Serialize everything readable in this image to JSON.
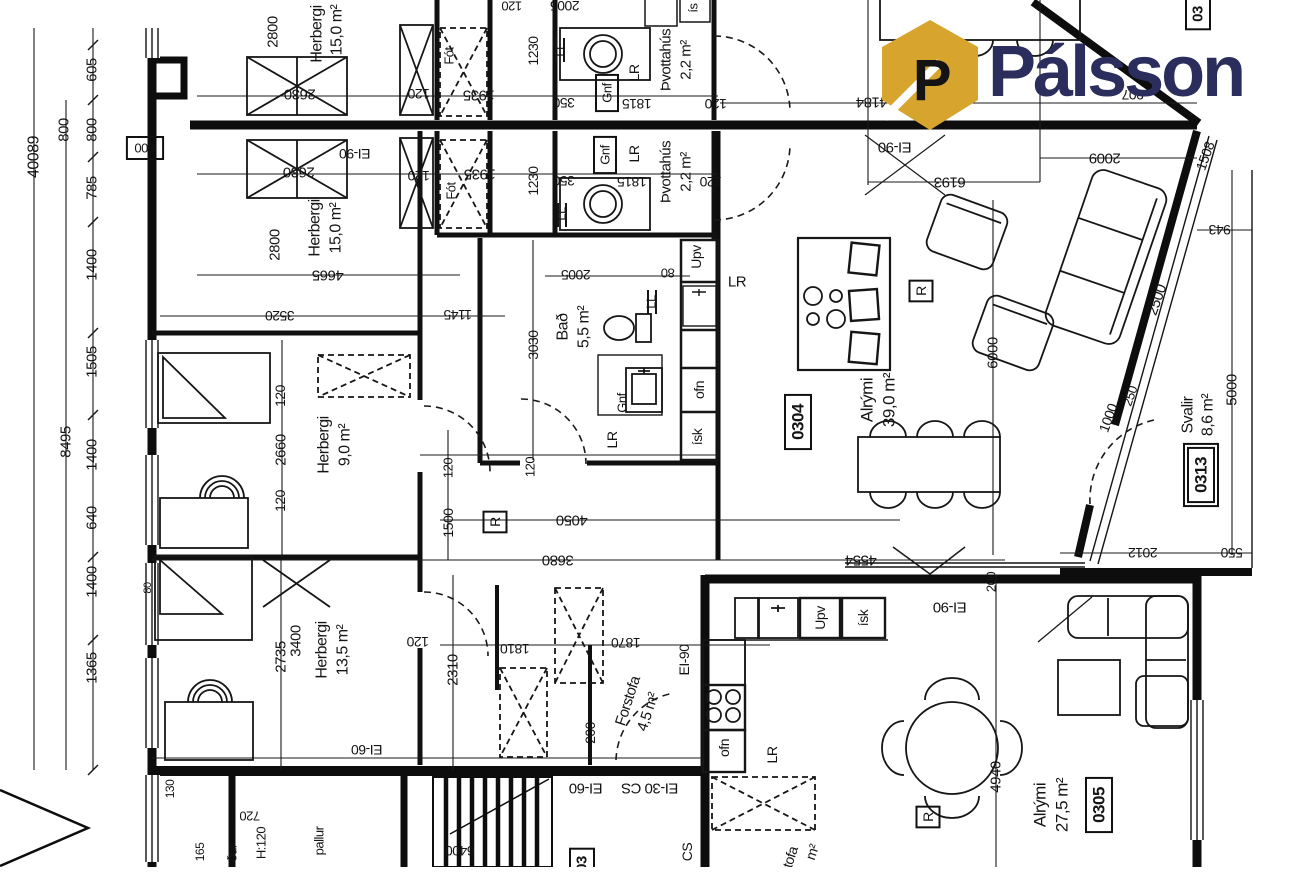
{
  "logo": {
    "text": "Pálsson",
    "icon": "house-p-icon",
    "brand_color": "#2b2d5c",
    "icon_color": "#d7a52e"
  },
  "plan": {
    "rooms": [
      {
        "number": "0304",
        "name": "Alrými",
        "area": "39,0 m²"
      },
      {
        "number": "0305",
        "name": "Alrými",
        "area": "27,5 m²"
      },
      {
        "number": "0313",
        "name": "Svalir",
        "area": "8,6 m²"
      },
      {
        "name": "Herbergi",
        "area": "15,0 m²"
      },
      {
        "name": "Herbergi",
        "area": "15,0 m²"
      },
      {
        "name": "Herbergi",
        "area": "9,0 m²"
      },
      {
        "name": "Herbergi",
        "area": "13,5 m²"
      },
      {
        "name": "Bað",
        "area": "5,5 m²"
      },
      {
        "name": "Þvottahús",
        "area": "2,2 m²"
      },
      {
        "name": "Þvottahús",
        "area": "2,2 m²"
      },
      {
        "name": "Forstofa",
        "area": "4,5 m²"
      }
    ],
    "fire_ratings": [
      "EI-90",
      "EI-60",
      "EI-30 CS",
      "CS"
    ],
    "labels": [
      {
        "t": "40089",
        "x": 34,
        "y": 157,
        "r": -90,
        "s": 16,
        "k": "dim"
      },
      {
        "t": "800",
        "x": 64,
        "y": 130,
        "r": -90,
        "s": 15,
        "k": "dim"
      },
      {
        "t": "605",
        "x": 92,
        "y": 70,
        "r": -90,
        "s": 15,
        "k": "dim"
      },
      {
        "t": "800",
        "x": 92,
        "y": 130,
        "r": -90,
        "s": 15,
        "k": "dim"
      },
      {
        "t": "785",
        "x": 92,
        "y": 188,
        "r": -90,
        "s": 15,
        "k": "dim"
      },
      {
        "t": "1400",
        "x": 92,
        "y": 265,
        "r": -90,
        "s": 15,
        "k": "dim"
      },
      {
        "t": "1505",
        "x": 92,
        "y": 362,
        "r": -90,
        "s": 15,
        "k": "dim"
      },
      {
        "t": "8495",
        "x": 66,
        "y": 442,
        "r": -90,
        "s": 15,
        "k": "dim"
      },
      {
        "t": "1400",
        "x": 92,
        "y": 455,
        "r": -90,
        "s": 15,
        "k": "dim"
      },
      {
        "t": "640",
        "x": 92,
        "y": 518,
        "r": -90,
        "s": 15,
        "k": "dim"
      },
      {
        "t": "1400",
        "x": 92,
        "y": 582,
        "r": -90,
        "s": 15,
        "k": "dim"
      },
      {
        "t": "1365",
        "x": 92,
        "y": 668,
        "r": -90,
        "s": 15,
        "k": "dim"
      },
      {
        "t": "600",
        "x": 145,
        "y": 148,
        "r": 180,
        "s": 13,
        "k": "dim",
        "b": 1
      },
      {
        "t": "80",
        "x": 148,
        "y": 588,
        "r": -90,
        "s": 11,
        "k": "dim"
      },
      {
        "t": "130",
        "x": 170,
        "y": 789,
        "r": -90,
        "s": 12,
        "k": "dim"
      },
      {
        "t": "165",
        "x": 200,
        "y": 852,
        "r": -90,
        "s": 12,
        "k": "dim"
      },
      {
        "t": "720",
        "x": 250,
        "y": 816,
        "r": 180,
        "s": 13,
        "k": "dim"
      },
      {
        "t": "H:120",
        "x": 261,
        "y": 843,
        "r": -90,
        "s": 13,
        "k": "note"
      },
      {
        "t": "ður",
        "x": 232,
        "y": 853,
        "r": -90,
        "s": 13,
        "k": "note"
      },
      {
        "t": "pallur",
        "x": 319,
        "y": 841,
        "r": -90,
        "s": 13,
        "k": "note"
      },
      {
        "t": "6400",
        "x": 460,
        "y": 851,
        "r": 180,
        "s": 14,
        "k": "dim"
      },
      {
        "t": "2800",
        "x": 273,
        "y": 32,
        "r": -90,
        "s": 15,
        "k": "dim"
      },
      {
        "t": "Herbergi",
        "x": 317,
        "y": 34,
        "r": -90,
        "s": 16,
        "k": "room"
      },
      {
        "t": "15,0 m²",
        "x": 337,
        "y": 30,
        "r": -90,
        "s": 16,
        "k": "room"
      },
      {
        "t": "2630",
        "x": 300,
        "y": 94,
        "r": 180,
        "s": 15,
        "k": "dim"
      },
      {
        "t": "120",
        "x": 419,
        "y": 94,
        "r": 180,
        "s": 14,
        "k": "dim"
      },
      {
        "t": "Fót",
        "x": 449,
        "y": 56,
        "r": -90,
        "s": 13,
        "k": "app"
      },
      {
        "t": "1935",
        "x": 479,
        "y": 95,
        "r": 180,
        "s": 15,
        "k": "dim"
      },
      {
        "t": "1230",
        "x": 533,
        "y": 51,
        "r": -90,
        "s": 14,
        "k": "dim"
      },
      {
        "t": "LL",
        "x": 560,
        "y": 50,
        "r": -90,
        "s": 13,
        "k": "app"
      },
      {
        "t": "350",
        "x": 564,
        "y": 103,
        "r": 180,
        "s": 14,
        "k": "dim"
      },
      {
        "t": "Gnf",
        "x": 607,
        "y": 93,
        "r": -90,
        "s": 13,
        "k": "app",
        "b": 1
      },
      {
        "t": "LR",
        "x": 634,
        "y": 73,
        "r": -90,
        "s": 14,
        "k": "app"
      },
      {
        "t": "Þvottahús",
        "x": 666,
        "y": 60,
        "r": -90,
        "s": 15,
        "k": "room"
      },
      {
        "t": "2,2 m²",
        "x": 686,
        "y": 60,
        "r": -90,
        "s": 15,
        "k": "room"
      },
      {
        "t": "1815",
        "x": 637,
        "y": 104,
        "r": 180,
        "s": 14,
        "k": "dim"
      },
      {
        "t": "120",
        "x": 716,
        "y": 104,
        "r": 180,
        "s": 14,
        "k": "dim"
      },
      {
        "t": "2005",
        "x": 565,
        "y": 6,
        "r": 180,
        "s": 14,
        "k": "dim"
      },
      {
        "t": "ís",
        "x": 693,
        "y": 8,
        "r": -90,
        "s": 13,
        "k": "app"
      },
      {
        "t": "120",
        "x": 512,
        "y": 6,
        "r": 180,
        "s": 13,
        "k": "dim"
      },
      {
        "t": "4184",
        "x": 872,
        "y": 102,
        "r": 180,
        "s": 15,
        "k": "dim"
      },
      {
        "t": "907",
        "x": 1133,
        "y": 95,
        "r": 180,
        "s": 14,
        "k": "dim"
      },
      {
        "t": "03",
        "x": 1198,
        "y": 14,
        "r": -90,
        "s": 15,
        "k": "num",
        "b": 1
      },
      {
        "t": "EI-90",
        "x": 895,
        "y": 147,
        "r": 180,
        "s": 15,
        "k": "fire"
      },
      {
        "t": "2630",
        "x": 299,
        "y": 172,
        "r": 180,
        "s": 15,
        "k": "dim"
      },
      {
        "t": "EI-90",
        "x": 355,
        "y": 154,
        "r": 180,
        "s": 14,
        "k": "fire"
      },
      {
        "t": "120",
        "x": 419,
        "y": 176,
        "r": 180,
        "s": 14,
        "k": "dim"
      },
      {
        "t": "1935",
        "x": 480,
        "y": 174,
        "r": 180,
        "s": 15,
        "k": "dim"
      },
      {
        "t": "Fót",
        "x": 451,
        "y": 191,
        "r": -90,
        "s": 13,
        "k": "app"
      },
      {
        "t": "1230",
        "x": 533,
        "y": 181,
        "r": -90,
        "s": 14,
        "k": "dim"
      },
      {
        "t": "350",
        "x": 564,
        "y": 181,
        "r": 180,
        "s": 14,
        "k": "dim"
      },
      {
        "t": "LL",
        "x": 561,
        "y": 214,
        "r": -90,
        "s": 13,
        "k": "app"
      },
      {
        "t": "Gnf",
        "x": 605,
        "y": 155,
        "r": -90,
        "s": 13,
        "k": "app",
        "b": 1
      },
      {
        "t": "LR",
        "x": 634,
        "y": 154,
        "r": -90,
        "s": 14,
        "k": "app"
      },
      {
        "t": "Þvottahús",
        "x": 666,
        "y": 172,
        "r": -90,
        "s": 15,
        "k": "room"
      },
      {
        "t": "2,2 m²",
        "x": 686,
        "y": 172,
        "r": -90,
        "s": 15,
        "k": "room"
      },
      {
        "t": "1815",
        "x": 632,
        "y": 182,
        "r": 180,
        "s": 14,
        "k": "dim"
      },
      {
        "t": "120",
        "x": 711,
        "y": 182,
        "r": 180,
        "s": 14,
        "k": "dim"
      },
      {
        "t": "2800",
        "x": 275,
        "y": 245,
        "r": -90,
        "s": 15,
        "k": "dim"
      },
      {
        "t": "Herbergi",
        "x": 315,
        "y": 228,
        "r": -90,
        "s": 16,
        "k": "room"
      },
      {
        "t": "15,0 m²",
        "x": 336,
        "y": 228,
        "r": -90,
        "s": 16,
        "k": "room"
      },
      {
        "t": "4665",
        "x": 328,
        "y": 275,
        "r": 180,
        "s": 15,
        "k": "dim"
      },
      {
        "t": "1145",
        "x": 458,
        "y": 315,
        "r": 180,
        "s": 14,
        "k": "dim"
      },
      {
        "t": "3520",
        "x": 280,
        "y": 316,
        "r": 180,
        "s": 14,
        "k": "dim"
      },
      {
        "t": "120",
        "x": 280,
        "y": 396,
        "r": -90,
        "s": 14,
        "k": "dim"
      },
      {
        "t": "2660",
        "x": 281,
        "y": 450,
        "r": -90,
        "s": 15,
        "k": "dim"
      },
      {
        "t": "120",
        "x": 280,
        "y": 501,
        "r": -90,
        "s": 14,
        "k": "dim"
      },
      {
        "t": "Herbergi",
        "x": 324,
        "y": 445,
        "r": -90,
        "s": 16,
        "k": "room"
      },
      {
        "t": "9,0 m²",
        "x": 345,
        "y": 445,
        "r": -90,
        "s": 16,
        "k": "room"
      },
      {
        "t": "1500",
        "x": 448,
        "y": 523,
        "r": -90,
        "s": 14,
        "k": "dim"
      },
      {
        "t": "120",
        "x": 448,
        "y": 468,
        "r": -90,
        "s": 13,
        "k": "dim"
      },
      {
        "t": "120",
        "x": 530,
        "y": 467,
        "r": -90,
        "s": 13,
        "k": "dim"
      },
      {
        "t": "R",
        "x": 495,
        "y": 522,
        "r": -90,
        "s": 14,
        "k": "app",
        "b": 1
      },
      {
        "t": "4050",
        "x": 572,
        "y": 520,
        "r": 180,
        "s": 15,
        "k": "dim"
      },
      {
        "t": "3680",
        "x": 558,
        "y": 560,
        "r": 180,
        "s": 15,
        "k": "dim"
      },
      {
        "t": "3030",
        "x": 533,
        "y": 345,
        "r": -90,
        "s": 14,
        "k": "dim"
      },
      {
        "t": "Bað",
        "x": 563,
        "y": 327,
        "r": -90,
        "s": 16,
        "k": "room"
      },
      {
        "t": "5,5 m²",
        "x": 584,
        "y": 327,
        "r": -90,
        "s": 16,
        "k": "room"
      },
      {
        "t": "2005",
        "x": 576,
        "y": 275,
        "r": 180,
        "s": 14,
        "k": "dim"
      },
      {
        "t": "80",
        "x": 668,
        "y": 273,
        "r": 180,
        "s": 13,
        "k": "dim"
      },
      {
        "t": "LL",
        "x": 651,
        "y": 302,
        "r": -90,
        "s": 13,
        "k": "app"
      },
      {
        "t": "Gnf",
        "x": 622,
        "y": 403,
        "r": -90,
        "s": 13,
        "k": "app"
      },
      {
        "t": "LR",
        "x": 612,
        "y": 440,
        "r": -90,
        "s": 14,
        "k": "app"
      },
      {
        "t": "Upv",
        "x": 696,
        "y": 257,
        "r": -90,
        "s": 14,
        "k": "app"
      },
      {
        "t": "ofn",
        "x": 699,
        "y": 390,
        "r": -90,
        "s": 14,
        "k": "app"
      },
      {
        "t": "ísk",
        "x": 697,
        "y": 437,
        "r": -90,
        "s": 14,
        "k": "app"
      },
      {
        "t": "LR",
        "x": 737,
        "y": 282,
        "r": 0,
        "s": 15,
        "k": "app"
      },
      {
        "t": "R",
        "x": 921,
        "y": 291,
        "r": -90,
        "s": 14,
        "k": "app",
        "b": 1
      },
      {
        "t": "6193",
        "x": 950,
        "y": 182,
        "r": 180,
        "s": 15,
        "k": "dim"
      },
      {
        "t": "6000",
        "x": 993,
        "y": 353,
        "r": -90,
        "s": 15,
        "k": "dim"
      },
      {
        "t": "0304",
        "x": 798,
        "y": 422,
        "r": -90,
        "s": 17,
        "k": "num",
        "b": 1
      },
      {
        "t": "Alrými",
        "x": 867,
        "y": 400,
        "r": -90,
        "s": 17,
        "k": "room"
      },
      {
        "t": "39,0 m²",
        "x": 889,
        "y": 400,
        "r": -90,
        "s": 17,
        "k": "room"
      },
      {
        "t": "2009",
        "x": 1105,
        "y": 158,
        "r": 180,
        "s": 15,
        "k": "dim"
      },
      {
        "t": "1508",
        "x": 1205,
        "y": 156,
        "r": -70,
        "s": 14,
        "k": "dim"
      },
      {
        "t": "2500",
        "x": 1157,
        "y": 300,
        "r": -70,
        "s": 15,
        "k": "dim"
      },
      {
        "t": "250",
        "x": 1130,
        "y": 396,
        "r": -70,
        "s": 13,
        "k": "dim"
      },
      {
        "t": "1000",
        "x": 1108,
        "y": 418,
        "r": -70,
        "s": 14,
        "k": "dim"
      },
      {
        "t": "Svalir",
        "x": 1188,
        "y": 415,
        "r": -90,
        "s": 16,
        "k": "room"
      },
      {
        "t": "8,6 m²",
        "x": 1208,
        "y": 415,
        "r": -90,
        "s": 16,
        "k": "room"
      },
      {
        "t": "5000",
        "x": 1232,
        "y": 390,
        "r": -90,
        "s": 15,
        "k": "dim"
      },
      {
        "t": "0313",
        "x": 1201,
        "y": 475,
        "r": -90,
        "s": 17,
        "k": "num",
        "b": 2
      },
      {
        "t": "943",
        "x": 1220,
        "y": 230,
        "r": 180,
        "s": 14,
        "k": "dim"
      },
      {
        "t": "2012",
        "x": 1143,
        "y": 553,
        "r": 180,
        "s": 14,
        "k": "dim"
      },
      {
        "t": "550",
        "x": 1232,
        "y": 553,
        "r": 180,
        "s": 14,
        "k": "dim"
      },
      {
        "t": "4554",
        "x": 861,
        "y": 560,
        "r": 180,
        "s": 15,
        "k": "dim"
      },
      {
        "t": "Herbergi",
        "x": 322,
        "y": 650,
        "r": -90,
        "s": 16,
        "k": "room"
      },
      {
        "t": "13,5 m²",
        "x": 343,
        "y": 650,
        "r": -90,
        "s": 16,
        "k": "room"
      },
      {
        "t": "2735",
        "x": 281,
        "y": 657,
        "r": -90,
        "s": 15,
        "k": "dim"
      },
      {
        "t": "3400",
        "x": 296,
        "y": 641,
        "r": -90,
        "s": 15,
        "k": "dim"
      },
      {
        "t": "120",
        "x": 418,
        "y": 642,
        "r": 180,
        "s": 14,
        "k": "dim"
      },
      {
        "t": "2310",
        "x": 453,
        "y": 670,
        "r": -90,
        "s": 15,
        "k": "dim"
      },
      {
        "t": "1810",
        "x": 515,
        "y": 649,
        "r": 180,
        "s": 14,
        "k": "dim"
      },
      {
        "t": "1870",
        "x": 626,
        "y": 643,
        "r": 180,
        "s": 14,
        "k": "dim"
      },
      {
        "t": "EI-90",
        "x": 684,
        "y": 660,
        "r": -90,
        "s": 14,
        "k": "fire"
      },
      {
        "t": "Forstofa",
        "x": 628,
        "y": 701,
        "r": -72,
        "s": 15,
        "k": "room"
      },
      {
        "t": "4,5 m²",
        "x": 648,
        "y": 712,
        "r": -72,
        "s": 15,
        "k": "room"
      },
      {
        "t": "200",
        "x": 590,
        "y": 733,
        "r": -90,
        "s": 14,
        "k": "dim"
      },
      {
        "t": "EI-60",
        "x": 367,
        "y": 750,
        "r": 180,
        "s": 14,
        "k": "fire"
      },
      {
        "t": "EI-60",
        "x": 586,
        "y": 788,
        "r": 180,
        "s": 15,
        "k": "fire"
      },
      {
        "t": "EI-30 CS",
        "x": 650,
        "y": 788,
        "r": 180,
        "s": 15,
        "k": "fire"
      },
      {
        "t": "CS",
        "x": 687,
        "y": 852,
        "r": -90,
        "s": 14,
        "k": "fire"
      },
      {
        "t": "03",
        "x": 582,
        "y": 864,
        "r": -90,
        "s": 15,
        "k": "num",
        "b": 1
      },
      {
        "t": "EI-90",
        "x": 950,
        "y": 607,
        "r": 180,
        "s": 15,
        "k": "fire"
      },
      {
        "t": "200",
        "x": 991,
        "y": 582,
        "r": -90,
        "s": 13,
        "k": "dim"
      },
      {
        "t": "Upv",
        "x": 820,
        "y": 618,
        "r": -90,
        "s": 14,
        "k": "app"
      },
      {
        "t": "ísk",
        "x": 863,
        "y": 618,
        "r": -90,
        "s": 14,
        "k": "app"
      },
      {
        "t": "ofn",
        "x": 724,
        "y": 748,
        "r": -90,
        "s": 14,
        "k": "app"
      },
      {
        "t": "LR",
        "x": 772,
        "y": 755,
        "r": -90,
        "s": 14,
        "k": "app"
      },
      {
        "t": "4940",
        "x": 996,
        "y": 777,
        "r": -90,
        "s": 15,
        "k": "dim"
      },
      {
        "t": "R",
        "x": 928,
        "y": 817,
        "r": -90,
        "s": 14,
        "k": "app",
        "b": 1
      },
      {
        "t": "Alrými",
        "x": 1040,
        "y": 805,
        "r": -90,
        "s": 17,
        "k": "room"
      },
      {
        "t": "27,5 m²",
        "x": 1062,
        "y": 805,
        "r": -90,
        "s": 17,
        "k": "room"
      },
      {
        "t": "0305",
        "x": 1099,
        "y": 805,
        "r": -90,
        "s": 17,
        "k": "num",
        "b": 1
      },
      {
        "t": "tofa",
        "x": 790,
        "y": 857,
        "r": -72,
        "s": 14,
        "k": "note"
      },
      {
        "t": "m²",
        "x": 812,
        "y": 852,
        "r": -72,
        "s": 14,
        "k": "note"
      }
    ]
  }
}
